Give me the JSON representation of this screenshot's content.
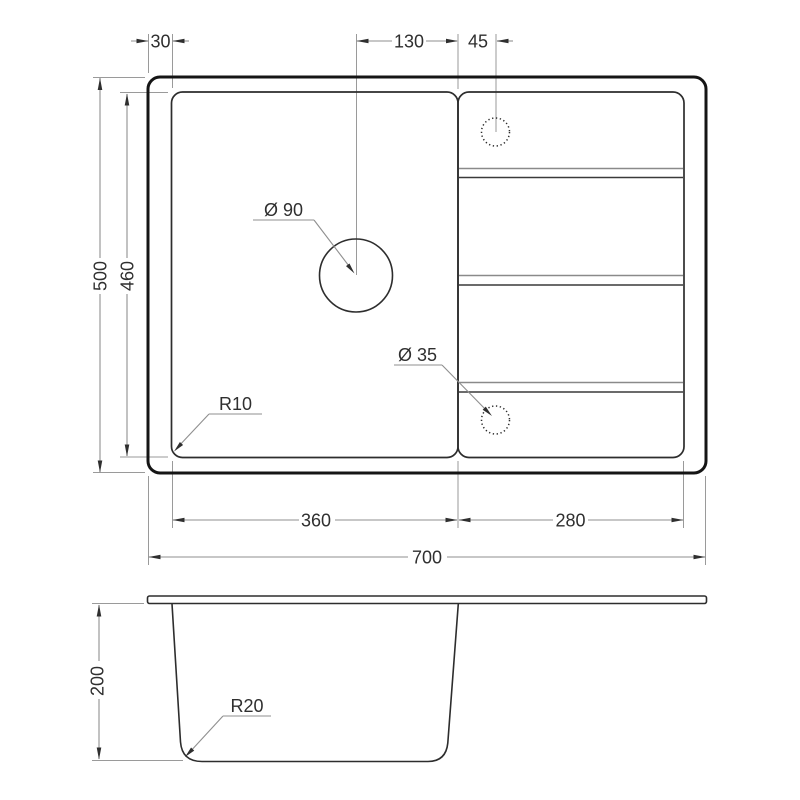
{
  "top_view": {
    "rim_offset": {
      "label": "30"
    },
    "hole_to_divider": {
      "label": "130"
    },
    "tap_hole_offset": {
      "label": "45"
    },
    "overall_depth": {
      "label": "500"
    },
    "inner_depth": {
      "label": "460"
    },
    "basin_width": {
      "label": "360"
    },
    "drainboard_width": {
      "label": "280"
    },
    "overall_width": {
      "label": "700"
    },
    "drain_hole_diameter": {
      "label": "Ø 90"
    },
    "tap_hole_diameter": {
      "label": "Ø 35"
    },
    "corner_radius": {
      "label": "R10"
    }
  },
  "side_view": {
    "bowl_depth": {
      "label": "200"
    },
    "bottom_radius": {
      "label": "R20"
    }
  }
}
